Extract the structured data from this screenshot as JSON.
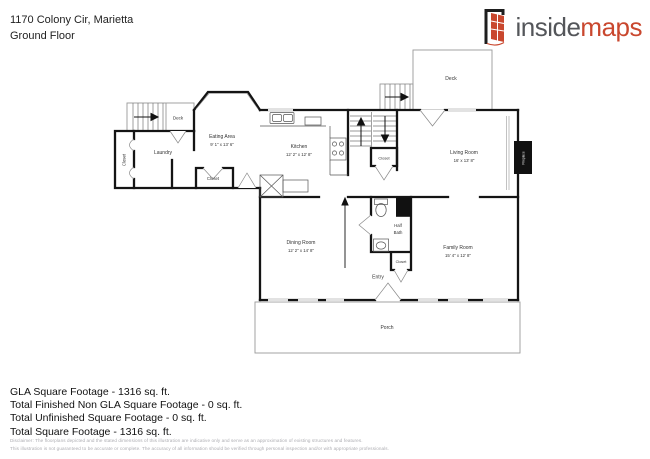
{
  "header": {
    "address": "1170 Colony Cir, Marietta",
    "floor": "Ground Floor"
  },
  "logo": {
    "brand_inside": "inside",
    "brand_maps": "maps",
    "accent_color": "#c9472e",
    "text_color": "#54565a",
    "icon": "open-door-icon"
  },
  "floorplan": {
    "labels": {
      "deck_left": "Deck",
      "deck_right": "Deck",
      "laundry": "Laundry",
      "closet_left": "Closet",
      "closet_corridor": "Closet",
      "eating_area": "Eating Area",
      "eating_area_dims": "9' 1\" x 13' 6\"",
      "kitchen": "Kitchen",
      "kitchen_dims": "12' 2\" x 12' 8\"",
      "closet_stairs": "Closet",
      "living_room": "Living Room",
      "living_room_dims": "16' x 13' 8\"",
      "fireplace": "Fireplace",
      "dining_room": "Dining Room",
      "dining_room_dims": "12' 2\" x 14' 8\"",
      "half_bath_line1": "Half",
      "half_bath_line2": "Bath",
      "closet_entry": "Closet",
      "entry": "Entry",
      "family_room": "Family Room",
      "family_room_dims": "15' 4\" x 12' 8\"",
      "porch": "Porch"
    }
  },
  "footer": {
    "stats": [
      "GLA Square Footage - 1316 sq. ft.",
      "Total Finished Non GLA Square Footage - 0 sq. ft.",
      "Total Unfinished Square Footage - 0 sq. ft.",
      "Total Square Footage - 1316 sq. ft."
    ],
    "disclaimer_line1": "Disclaimer: The floorplans depicted and the stated dimensions of this illustration are indicative only and serve as an approximation of existing structures and features.",
    "disclaimer_line2": "This illustration is not guaranteed to be accurate or complete. The accuracy of all information should be verified through personal inspection and/or with appropriate professionals."
  }
}
